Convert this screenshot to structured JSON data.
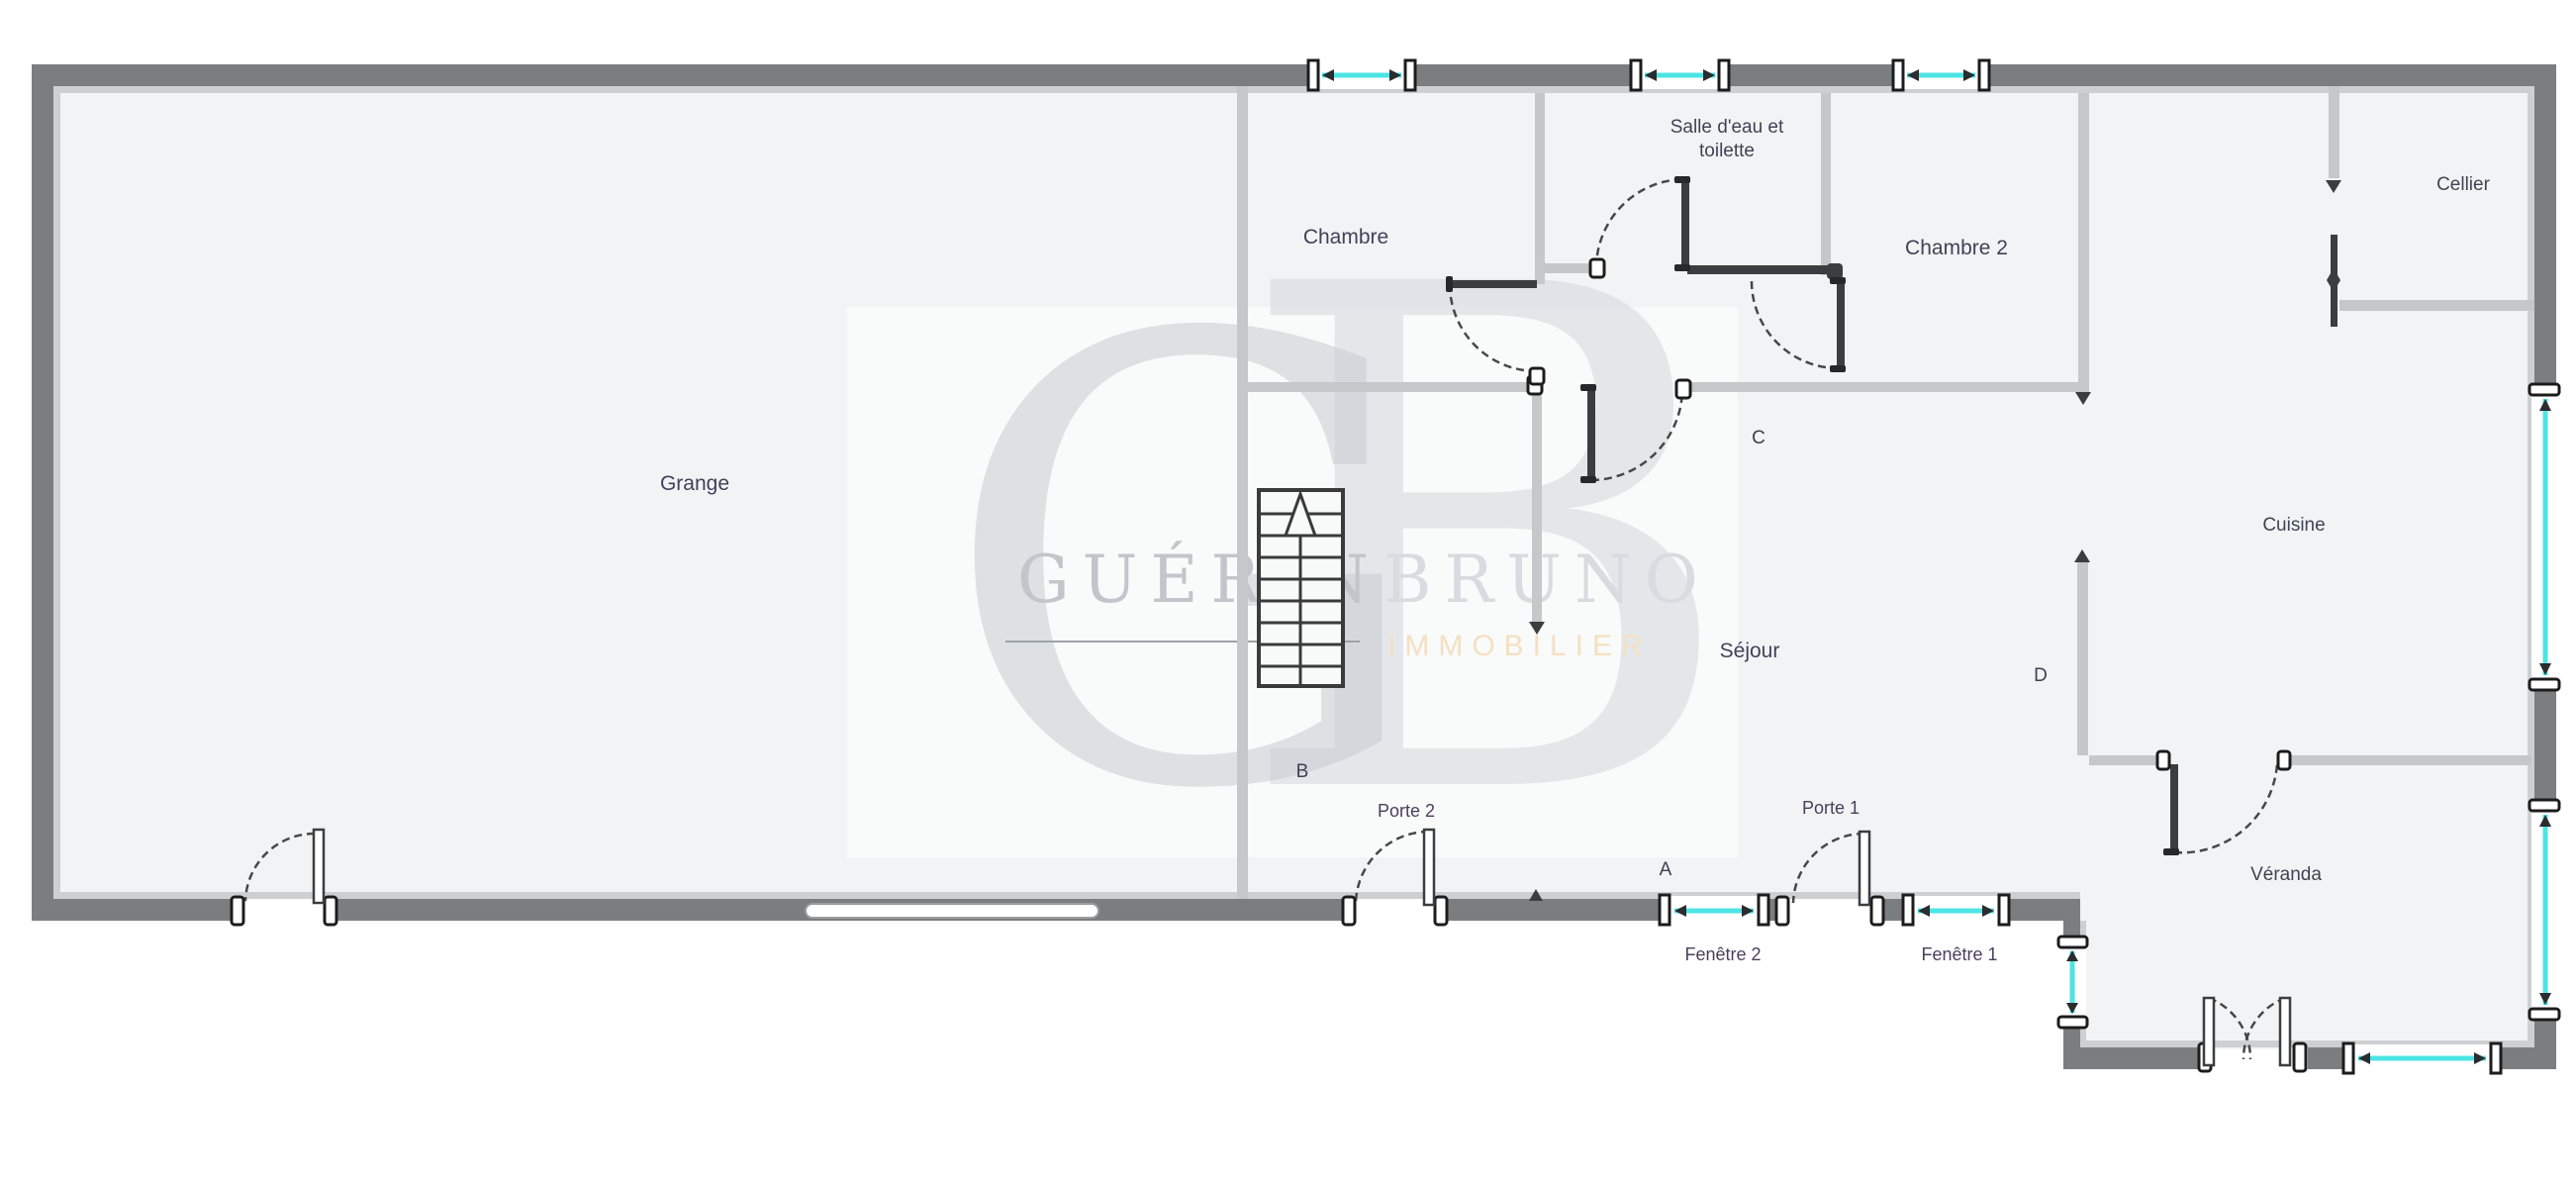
{
  "plan": {
    "type": "floor-plan",
    "agency_watermark": {
      "monogram_g": "G",
      "monogram_b": "B",
      "name_primary": "GUÉRIN",
      "name_secondary": "BRUNO",
      "tagline": "IMMOBILIER"
    },
    "rooms": {
      "grange": "Grange",
      "chambre": "Chambre",
      "salle_deau_line1": "Salle d'eau et",
      "salle_deau_line2": "toilette",
      "chambre2": "Chambre 2",
      "cellier": "Cellier",
      "cuisine": "Cuisine",
      "sejour": "Séjour",
      "veranda": "Véranda"
    },
    "doors": {
      "porte1": "Porte 1",
      "porte2": "Porte 2"
    },
    "windows": {
      "fenetre1": "Fenêtre 1",
      "fenetre2": "Fenêtre 2"
    },
    "markers": {
      "a": "A",
      "b": "B",
      "c": "C",
      "d": "D"
    },
    "colors": {
      "outer_wall": "#7b7e80",
      "inner_wall_face": "#cdd0d3",
      "partition_wall": "#c5c8ca",
      "dark_wall": "#3b3e40",
      "glass_cyan": "#4de4e4",
      "floor": "#f2f3f4",
      "label_text": "#44405a",
      "brand_gray": "#c6cad0",
      "brand_tan": "#f4e0c2"
    }
  }
}
